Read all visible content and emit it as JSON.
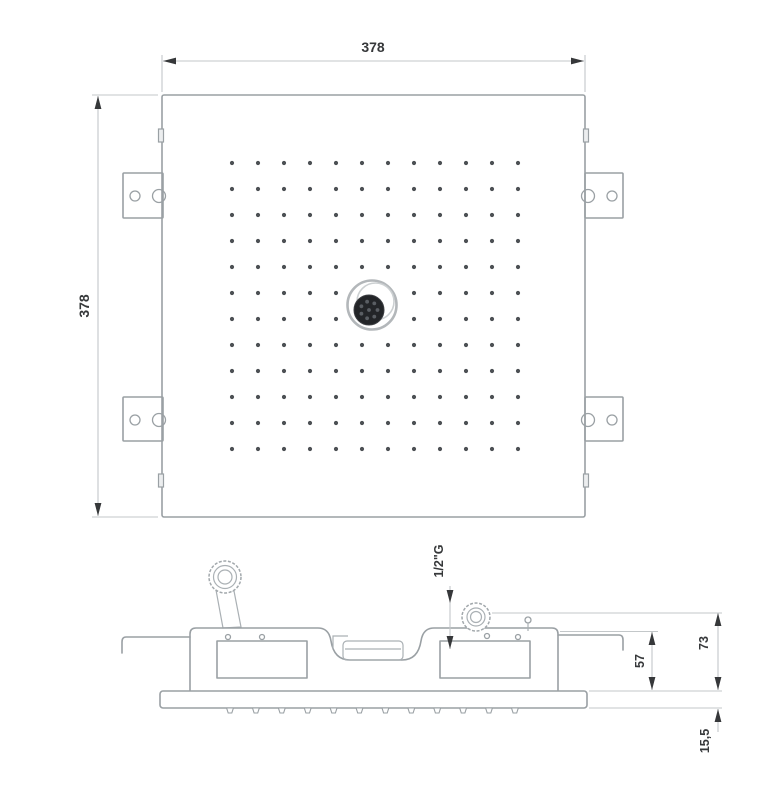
{
  "diagram": {
    "kind": "technical-drawing-shower-head",
    "labels": {
      "top_width": "378",
      "left_height": "378",
      "inlet_thread": "1/2\"G",
      "frame_depth": "57",
      "total_depth": "73",
      "flange_thickness": "15,5"
    },
    "colors": {
      "line": "#9aa0a4",
      "dim_line": "#c3c7c9",
      "arrow_text": "#36383a",
      "nozzle_dot": "#4c5054",
      "fitting_dark": "#232528",
      "fitting_dot": "#5a5e63"
    },
    "nozzle_grid": {
      "rows": 12,
      "cols": 12
    },
    "side_nozzles": {
      "count": 12
    }
  }
}
